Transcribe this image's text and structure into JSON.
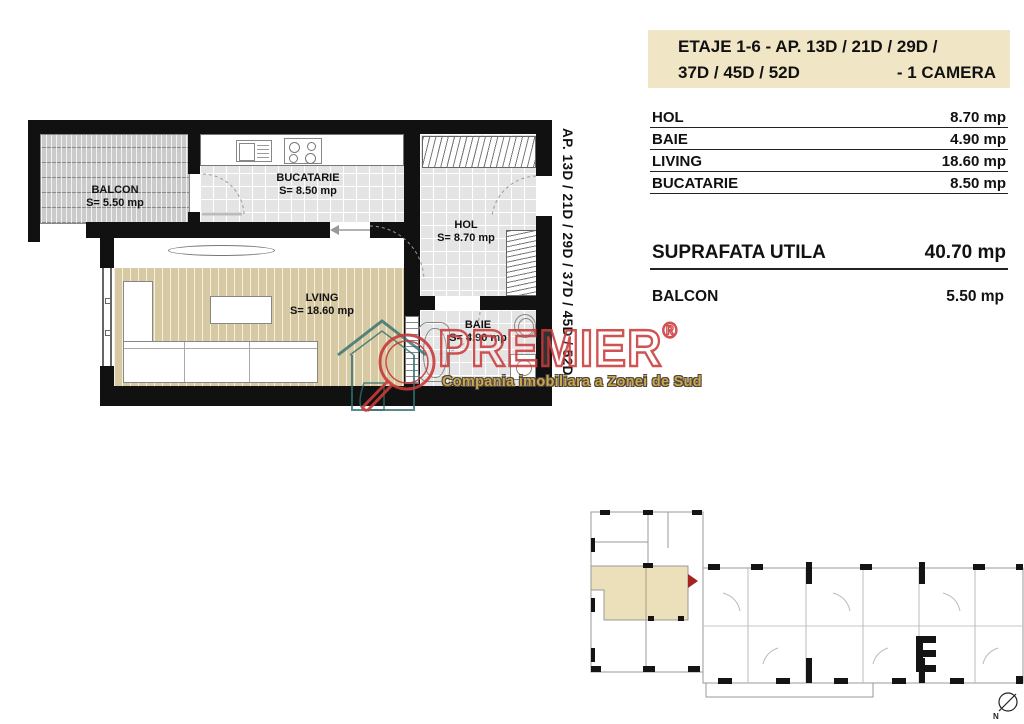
{
  "header": {
    "line1": "ETAJE 1-6 -  AP.  13D / 21D / 29D /",
    "line2_left": "37D / 45D / 52D",
    "line2_right": "- 1 CAMERA"
  },
  "areas": {
    "rows": [
      {
        "label": "HOL",
        "value": "8.70 mp"
      },
      {
        "label": "BAIE",
        "value": "4.90 mp"
      },
      {
        "label": "LIVING",
        "value": "18.60 mp"
      },
      {
        "label": "BUCATARIE",
        "value": "8.50 mp"
      }
    ]
  },
  "summary": {
    "label": "SUPRAFATA UTILA",
    "value": "40.70 mp"
  },
  "balcony": {
    "label": "BALCON",
    "value": "5.50 mp"
  },
  "plan": {
    "side_text": "AP.  13D / 21D / 29D / 37D / 45D / 52D",
    "rooms": {
      "balcon": {
        "name": "BALCON",
        "area": "S= 5.50 mp"
      },
      "bucatarie": {
        "name": "BUCATARIE",
        "area": "S= 8.50 mp"
      },
      "hol": {
        "name": "HOL",
        "area": "S= 8.70 mp"
      },
      "living": {
        "name": "LVING",
        "area": "S= 18.60 mp"
      },
      "baie": {
        "name": "BAIE",
        "area": "S= 4.90 mp"
      }
    }
  },
  "watermark": {
    "brand": "PREMIER",
    "registered": "®",
    "tagline": "Compania imobiliara a Zonei de Sud"
  },
  "keyplan": {
    "compass_label": "N"
  },
  "colors": {
    "header_beige": "#f0e6c6",
    "highlight_beige": "#ece0ba",
    "wood_floor": "#d7c9a2",
    "tile_gray": "#e4e4e4",
    "watermark_red": "#c93a3a",
    "tagline_gold": "#cfa54f",
    "logo_teal": "#2f6f6f",
    "wall_black": "#111111"
  }
}
